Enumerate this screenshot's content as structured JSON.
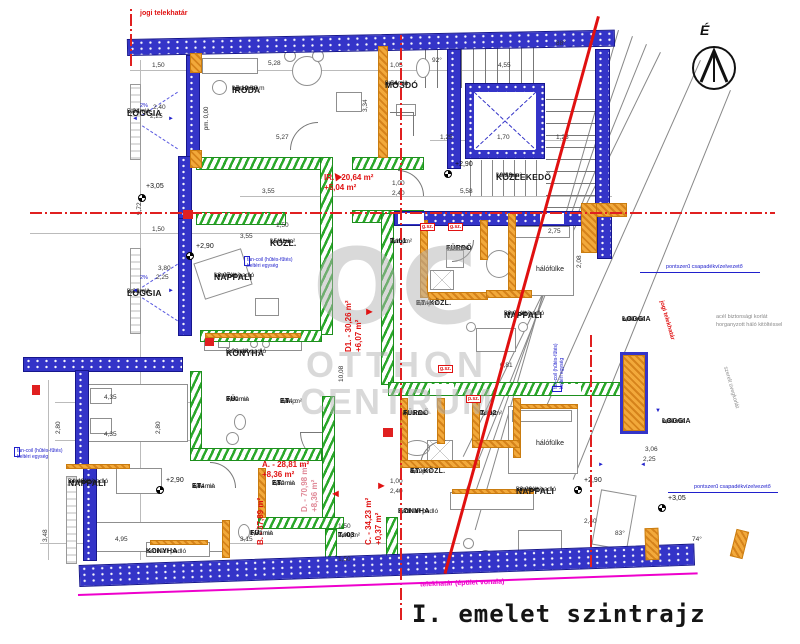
{
  "title": "I. emelet szintrajz",
  "compass": {
    "label": "É"
  },
  "watermark": {
    "logo": "OC",
    "line1": "OTTHON",
    "line2": "CENTRUM"
  },
  "boundaries": {
    "top": "jogi telekhatár",
    "right": "jogi telekhatár",
    "bottom": "telekhatár (épület vonala)"
  },
  "notes": {
    "drain": "pontszerű csapadékvízelvezető",
    "drain2": "pontszerű csapadékvízelvezető",
    "railing1": "acél biztonsági korlát",
    "railing2": "horganyzott háló kitöltéssel",
    "glass": "szerelt üvegkorlát",
    "fancoil1": "fan-coil (hűtés-fűtés)",
    "fancoil2": "beltéri egység",
    "pm": "pm. 0,00",
    "gsz": "g.sz.",
    "psz": "p.sz.",
    "slope": "2%"
  },
  "rooms": [
    {
      "n": "LOGGIA",
      "f": "kerámia",
      "a": "5,04 m²"
    },
    {
      "n": "IRODA",
      "f": "kerámia",
      "a": "17,10 m²",
      "b": "bm: 2,88 m"
    },
    {
      "n": "MOSDÓ",
      "f": "kerámia",
      "a": "3,54 m²"
    },
    {
      "n": "KÖZLEKEDŐ",
      "f": "kerámia",
      "a": "19,29 m²"
    },
    {
      "n": "KÖZL.",
      "f": "kerámia",
      "a": "15,11 m²"
    },
    {
      "n": "NAPPALI",
      "f": "laminált padló",
      "a": "18,07 m²"
    },
    {
      "n": "LOGGIA",
      "f": "kerámia",
      "a": "8,36 m²"
    },
    {
      "n": "KONYHA",
      "f": "laminált padló",
      "a": "5,06 m²"
    },
    {
      "n": "T.-01",
      "f": "lam.p.",
      "a": "2,15 m²"
    },
    {
      "n": "FÜRDŐ",
      "f": "kerámia",
      "a": "4,06 m²"
    },
    {
      "n": "hálófülke",
      "f": "",
      "a": ""
    },
    {
      "n": "NAPPALI",
      "f": "laminált padló",
      "a": "20,91 m²"
    },
    {
      "n": "ET.-KÖZL.",
      "f": "lam.p.",
      "a": "2,24 m²"
    },
    {
      "n": "FÜ.",
      "f": "kerámia",
      "a": "3,60 m²"
    },
    {
      "n": "ET.",
      "f": "lam.p.",
      "a": "2,04 m²"
    },
    {
      "n": "FÜRDŐ",
      "f": "kerámia",
      "a": "4,06 m²"
    },
    {
      "n": "T.-02",
      "f": "lam.p.",
      "a": "2,05 m²"
    },
    {
      "n": "hálófülke",
      "f": "",
      "a": ""
    },
    {
      "n": "NAPPALI",
      "f": "laminált padló",
      "a": "24,48 m²"
    },
    {
      "n": "ET.",
      "f": "kerámia",
      "a": "3,04 m²"
    },
    {
      "n": "ET.",
      "f": "kerámia",
      "a": "2,50 m²"
    },
    {
      "n": "KONYHA",
      "f": "laminált padló",
      "a": ""
    },
    {
      "n": "FÜ.",
      "f": "kerámia",
      "a": "1,73 m²"
    },
    {
      "n": "T.-03",
      "f": "lam.p.",
      "a": "2,09 m²"
    },
    {
      "n": "ET.-KÖZL.",
      "f": "lam.p.",
      "a": "4,12 m²"
    },
    {
      "n": "KONYHA",
      "f": "laminált padló",
      "a": "3,71 m²"
    },
    {
      "n": "NAPPALI",
      "f": "laminált padló",
      "a": "20,29 m²"
    },
    {
      "n": "LOGGIA",
      "f": "kerámia",
      "a": "6,07 m²"
    },
    {
      "n": "LOGGIA",
      "f": "kerámia",
      "a": "0,37 m²"
    }
  ],
  "units": [
    {
      "l1": "IR. - 20,64 m²",
      "l2": "+5,04 m²"
    },
    {
      "l1": "A. - 28,81 m²",
      "l2": "+8,36 m²"
    },
    {
      "l1": "B. - 37,89 m²",
      "l2": ""
    },
    {
      "l1": "C. - 34,23 m²",
      "l2": "+0,37 m²"
    },
    {
      "l1": "D1. - 30,26 m²",
      "l2": "+6,07 m²"
    },
    {
      "l1": "D. - 70,98 m²",
      "l2": "+8,36 m²"
    }
  ],
  "levels": [
    "+3,05",
    "+2,90",
    "+2,90",
    "+2,90",
    "+2,90",
    "+3,05"
  ],
  "dims": [
    "1,50",
    "5,28",
    "1,05",
    "4,55",
    "92°",
    "88°",
    "5,27",
    "3,34",
    "1,25",
    "1,70",
    "1,25",
    "5,58",
    "3,55",
    "3,55",
    "1,50",
    "1,50",
    "2,40",
    "2,25",
    "3,80",
    "2,25",
    "9,72",
    "2,75",
    "2,08",
    "10,08",
    "6,81",
    "4,35",
    "4,35",
    "2,80",
    "2,80",
    "3,48",
    "4,95",
    "3,15",
    "1,50",
    "1,50",
    "1,00",
    "2,40",
    "1,00",
    "2,40",
    "83°",
    "74°",
    "3,06",
    "2,25",
    "2,40"
  ]
}
